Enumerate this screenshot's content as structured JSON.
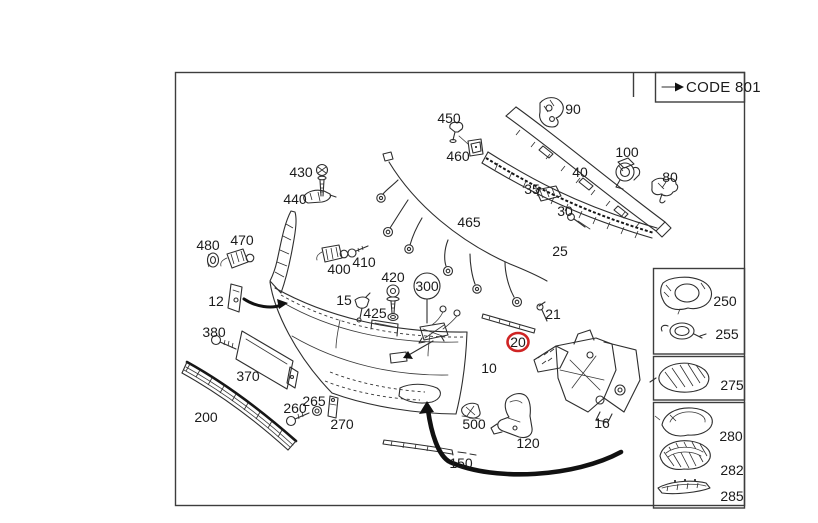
{
  "code_box": {
    "label": "CODE 801",
    "arrow_icon": "right-arrow"
  },
  "diagram": {
    "highlighted_callout": {
      "number": "20",
      "ring_color": "#cf2424"
    },
    "balloon_callout": {
      "number": "300"
    },
    "callouts": {
      "10": "10",
      "12": "12",
      "15": "15",
      "16": "16",
      "21": "21",
      "25": "25",
      "30": "30",
      "35": "35",
      "40": "40",
      "80": "80",
      "90": "90",
      "100": "100",
      "120": "120",
      "150": "150",
      "200": "200",
      "260": "260",
      "265": "265",
      "270": "270",
      "370": "370",
      "380": "380",
      "400": "400",
      "410": "410",
      "420": "420",
      "425": "425",
      "430": "430",
      "440": "440",
      "450": "450",
      "460": "460",
      "465": "465",
      "470": "470",
      "480": "480",
      "500": "500"
    }
  },
  "side_panel": {
    "cells": [
      {
        "number": "250"
      },
      {
        "number": "255"
      },
      {
        "number": "275"
      },
      {
        "number": "280"
      },
      {
        "number": "282"
      },
      {
        "number": "285"
      }
    ]
  }
}
